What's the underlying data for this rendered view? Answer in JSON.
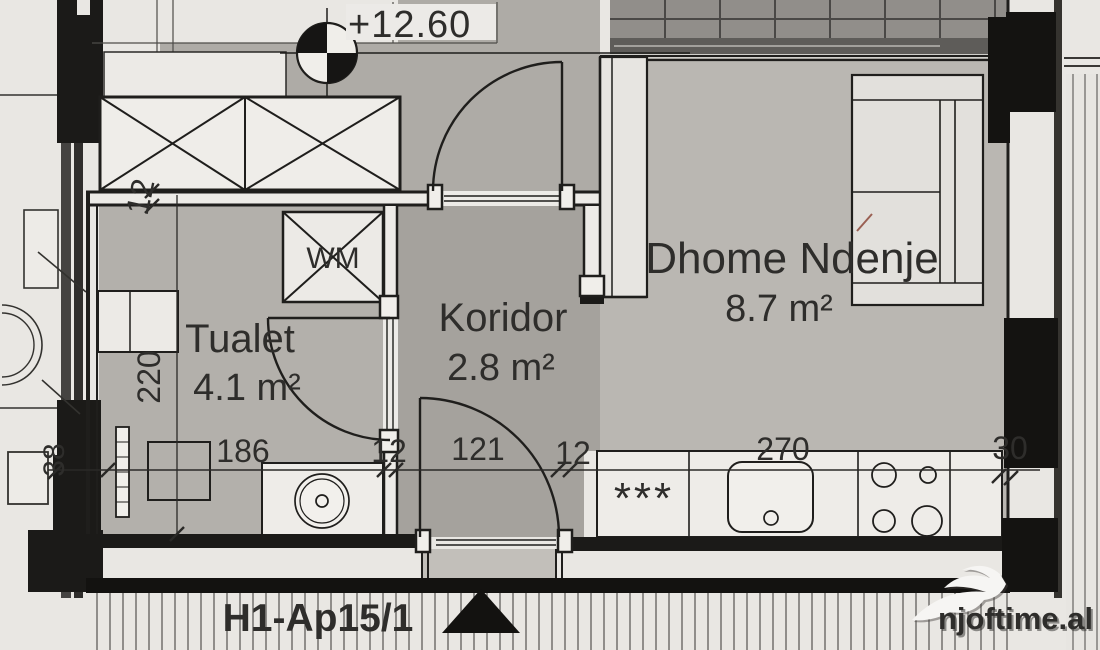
{
  "plan": {
    "elevation": "+12.60",
    "unit_label": "H1-Ap15/1",
    "watermark": "njoftime.al",
    "rooms": {
      "tualet": {
        "name": "Tualet",
        "area": "4.1 m²"
      },
      "koridor": {
        "name": "Koridor",
        "area": "2.8 m²"
      },
      "dhome_ndenje": {
        "name": "Dhome Ndenje",
        "area": "8.7 m²"
      }
    },
    "fixtures": {
      "washing_machine": "WM",
      "fridge_stars": "***"
    },
    "dimensions": {
      "bottom_chain": [
        "186",
        "12",
        "121",
        "12",
        "270",
        "30"
      ],
      "left_chain": [
        "12",
        "220",
        "38"
      ]
    },
    "colors": {
      "paper": "#e9e7e3",
      "room_grey": "#b3b0ab",
      "koridor_grey": "#a5a29d",
      "dhome_grey": "#bab7b2",
      "lobby_grey": "#aeaba6",
      "wall_black": "#1f1e1c",
      "watermark_white": "#f6f5f3"
    }
  }
}
